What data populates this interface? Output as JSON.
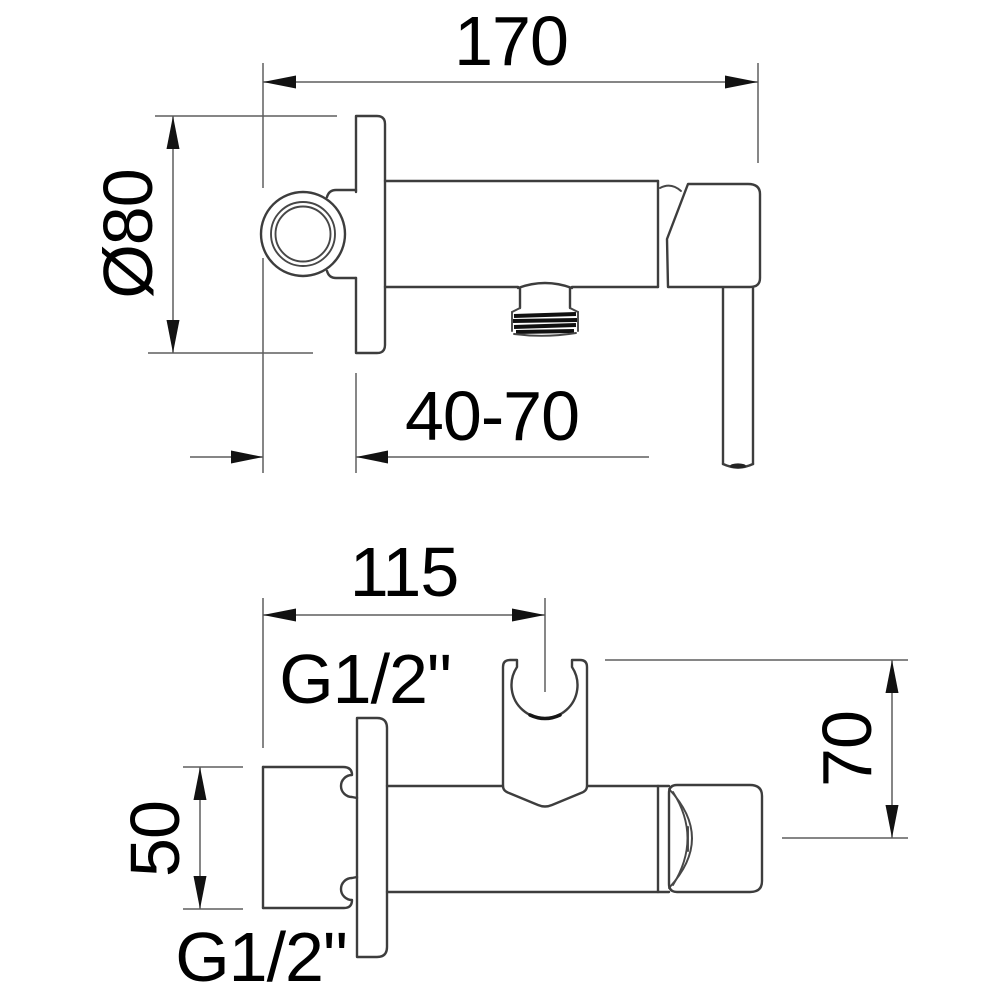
{
  "meta": {
    "background_color": "#ffffff",
    "object_line_color": "#3d3d3d",
    "dimension_line_color": "#5f5f5f",
    "text_color": "#000000"
  },
  "top_view": {
    "dim_total_length": "170",
    "dim_plate_diameter": "Ø80",
    "dim_wall_distance_range": "40-70"
  },
  "front_view": {
    "dim_holder_spacing": "115",
    "outlet_thread_label": "G1/2\"",
    "dim_holder_height": "70",
    "dim_block_height": "50",
    "inlet_thread_label": "G1/2\""
  }
}
